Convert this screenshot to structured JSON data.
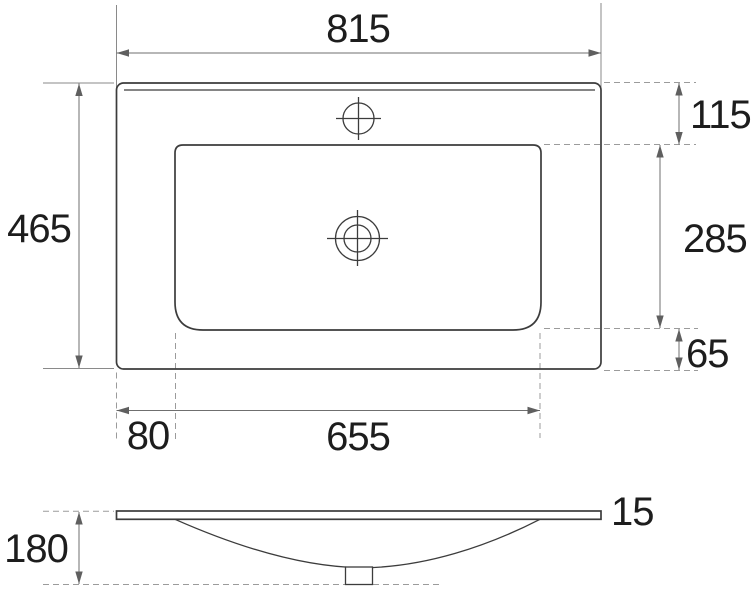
{
  "drawing": {
    "type": "washbasin-technical-drawing",
    "views": [
      "top-view",
      "side-view"
    ]
  },
  "dims": {
    "overall_width": "815",
    "overall_depth": "465",
    "back_edge_to_basin": "115",
    "basin_depth": "285",
    "basin_to_front_edge": "65",
    "left_edge_to_basin": "80",
    "basin_width": "655",
    "rim_thickness": "15",
    "overall_height": "180"
  },
  "colors": {
    "background": "#ffffff",
    "outline": "#3c3c3c",
    "dimension_line": "#6f6f6f",
    "extension_dashed": "#9b9b9b",
    "label_text": "#1d1d1d"
  }
}
